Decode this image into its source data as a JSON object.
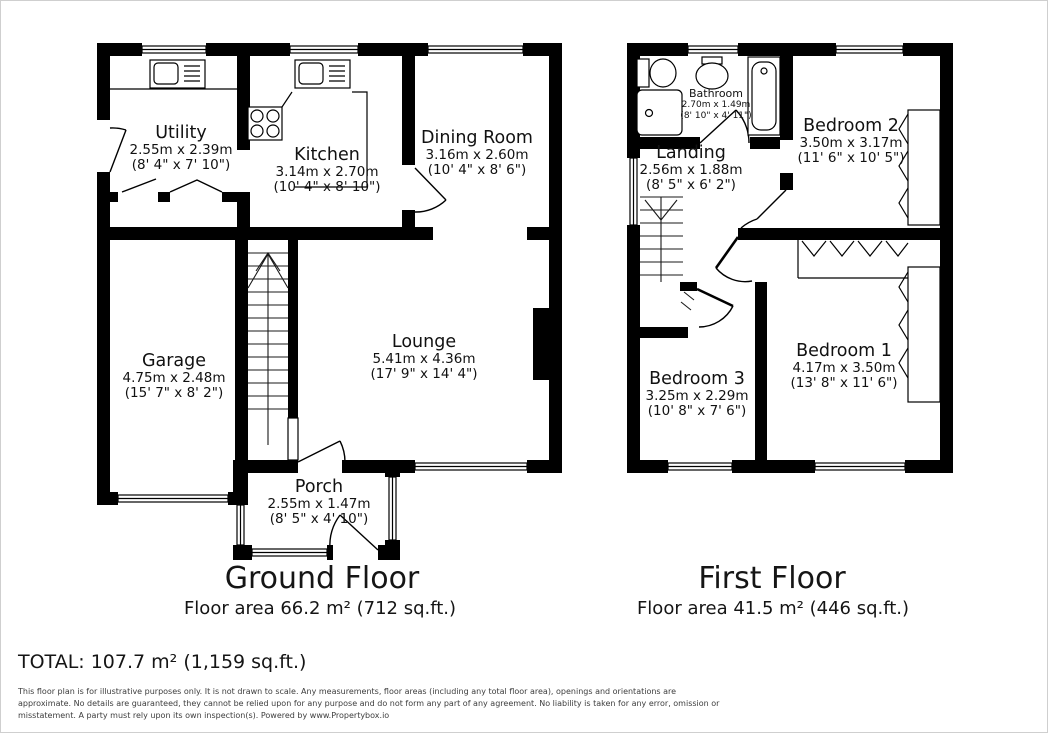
{
  "ground_floor": {
    "title": "Ground Floor",
    "area": "Floor area 66.2 m² (712 sq.ft.)",
    "rooms": [
      {
        "name": "Utility",
        "metric": "2.55m x 2.39m",
        "imperial": "(8' 4\" x 7' 10\")"
      },
      {
        "name": "Kitchen",
        "metric": "3.14m x 2.70m",
        "imperial": "(10' 4\" x 8' 10\")"
      },
      {
        "name": "Dining Room",
        "metric": "3.16m x 2.60m",
        "imperial": "(10' 4\" x 8' 6\")"
      },
      {
        "name": "Garage",
        "metric": "4.75m x 2.48m",
        "imperial": "(15' 7\" x 8' 2\")"
      },
      {
        "name": "Lounge",
        "metric": "5.41m x 4.36m",
        "imperial": "(17' 9\" x 14' 4\")"
      },
      {
        "name": "Porch",
        "metric": "2.55m x 1.47m",
        "imperial": "(8' 5\" x 4' 10\")"
      }
    ]
  },
  "first_floor": {
    "title": "First Floor",
    "area": "Floor area 41.5 m² (446 sq.ft.)",
    "rooms": [
      {
        "name": "Bathroom",
        "metric": "2.70m x 1.49m",
        "imperial": "(8' 10\" x 4' 11\")"
      },
      {
        "name": "Landing",
        "metric": "2.56m x 1.88m",
        "imperial": "(8' 5\" x 6' 2\")"
      },
      {
        "name": "Bedroom 2",
        "metric": "3.50m x 3.17m",
        "imperial": "(11' 6\" x 10' 5\")"
      },
      {
        "name": "Bedroom 1",
        "metric": "4.17m x 3.50m",
        "imperial": "(13' 8\" x 11' 6\")"
      },
      {
        "name": "Bedroom 3",
        "metric": "3.25m x 2.29m",
        "imperial": "(10' 8\" x 7' 6\")"
      }
    ]
  },
  "total": "TOTAL: 107.7 m² (1,159 sq.ft.)",
  "disclaimer_lines": [
    "This floor plan is for illustrative purposes only. It is not drawn to scale. Any measurements, floor areas (including any total floor area), openings and orientations are",
    "approximate. No details are guaranteed, they cannot be relied upon for any purpose and do not form any part of any agreement. No liability is taken for any error, omission or",
    "misstatement. A party must rely upon its own inspection(s). Powered by www.Propertybox.io"
  ],
  "colors": {
    "wall": "#000000",
    "background": "#ffffff",
    "text": "#151515",
    "disclaimer_text": "#3d3d3d"
  }
}
